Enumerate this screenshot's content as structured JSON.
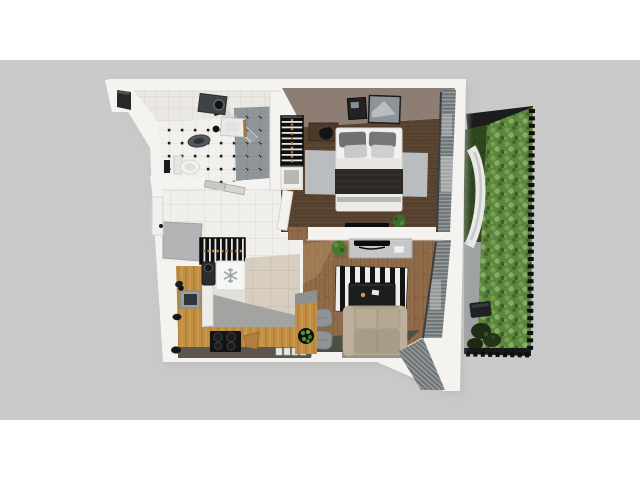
{
  "meta": {
    "type": "3d-floorplan-render",
    "description": "Top-down 3D architectural render of a one-bedroom apartment with a side balcony, letterboxed on a gray field",
    "canvas": {
      "width": 640,
      "height": 480
    },
    "letterbox": {
      "top_height": 60,
      "bottom_height": 60
    }
  },
  "colors": {
    "margin_white": "#ffffff",
    "bg_gray": "#c9c9c9",
    "wall_white": "#f4f3f0",
    "wall_edge": "#d8d5d0",
    "wall_taupe": "#8d7d73",
    "niche_dark": "#26282a",
    "bath_tile_white": "#f1f0ec",
    "bath_tile_gray": "#8f9598",
    "wall_tile": "#eae8e3",
    "hall_tile": "#f0efeb",
    "beige_tile": "#d7cec0",
    "kitchen_floor": "#a3a3a1",
    "counter_oak": "#c28f44",
    "counter_front": "#5a564e",
    "counter_top_gray": "#8e9192",
    "cabinet_face": "#edebe7",
    "stove_black": "#121314",
    "fridge_white": "#f6f6f4",
    "appliance_dark": "#3f4246",
    "wardrobe_black": "#0f0f0f",
    "hanger_tan": "#b5854a",
    "bedroom_floor": "#5a4533",
    "living_floor": "#8f6b49",
    "sun_patch": "#bb9266",
    "olive_floor": "#4b4f45",
    "bed_white": "#f2f1ee",
    "pillow_gray": "#6e7174",
    "throw_dark": "#2c2824",
    "bed_rug_gray": "#babdbf",
    "nightstand_wood": "#4b3a2b",
    "rug_black": "#141414",
    "rug_white": "#efeeeb",
    "sofa_beige": "#b1a591",
    "sofa_arm": "#bcb09c",
    "table_black": "#1c1d1f",
    "console_gray": "#c4c6c7",
    "tv_black": "#0b0c0d",
    "stool_gray": "#8f9395",
    "mat_gray": "#b2b4b5",
    "door_white": "#f2f0ec",
    "blinds_base": "#747a7c",
    "blinds_light": "#cfd2d2",
    "hedge_green": "#5d8440",
    "turf_green": "#2f471e",
    "concrete_gray": "#9ea2a3",
    "fence_black": "#0d0d0d",
    "balcony_shadow": "#1a1c1e",
    "plant_green": "#46792d",
    "shrub_dark": "#1f2d16",
    "lounger_white": "#e9e9e7",
    "box_black": "#1f2124",
    "board_wood": "#b07f3f",
    "basin_gray": "#54585c",
    "toilet_white": "#f3f2ef"
  },
  "scene": {
    "background": "gray field with white letterbox band at top and bottom",
    "rooms": [
      {
        "name": "bathroom",
        "position": "top-left",
        "floor": "white tiles with black accent dots, gray shower zone",
        "fixtures": [
          "washing-machine",
          "shower-glass",
          "vanity-sink",
          "countertop-basin",
          "toilet",
          "flush-plate",
          "wall-niche"
        ]
      },
      {
        "name": "hallway",
        "position": "center-left",
        "floor": "white tiles",
        "features": [
          "entry-door",
          "doormat",
          "hanger-wardrobe",
          "shoe-cabinet",
          "bathroom-door"
        ]
      },
      {
        "name": "bedroom",
        "position": "top-right",
        "floor": "dark wood planks",
        "features": [
          "double-bed",
          "nightstand",
          "table-lamp",
          "wall-pictures",
          "hanger-closet",
          "gray-rug",
          "wall-tv",
          "potted-plant",
          "window-blinds",
          "open-door"
        ]
      },
      {
        "name": "kitchen",
        "position": "bottom-left",
        "floor": "gray work zone with beige dining tiles",
        "features": [
          "u-shaped-oak-counter",
          "sink",
          "cooktop",
          "fridge-with-snowflake",
          "coffee-machine",
          "cutting-board",
          "herb-pot",
          "power-sockets"
        ]
      },
      {
        "name": "living-room",
        "position": "bottom-right",
        "floor": "oak planks with sunlight patch",
        "features": [
          "striped-rug",
          "coffee-table",
          "sofa",
          "tv-console",
          "potted-plant",
          "bar-stools",
          "window-blinds",
          "chamfered-window-corner"
        ]
      },
      {
        "name": "balcony",
        "position": "right",
        "features": [
          "green-hedge-wall",
          "artificial-turf",
          "concrete-deck",
          "white-lounger",
          "storage-box",
          "dark-shrub",
          "metal-fence-posts"
        ]
      }
    ]
  }
}
